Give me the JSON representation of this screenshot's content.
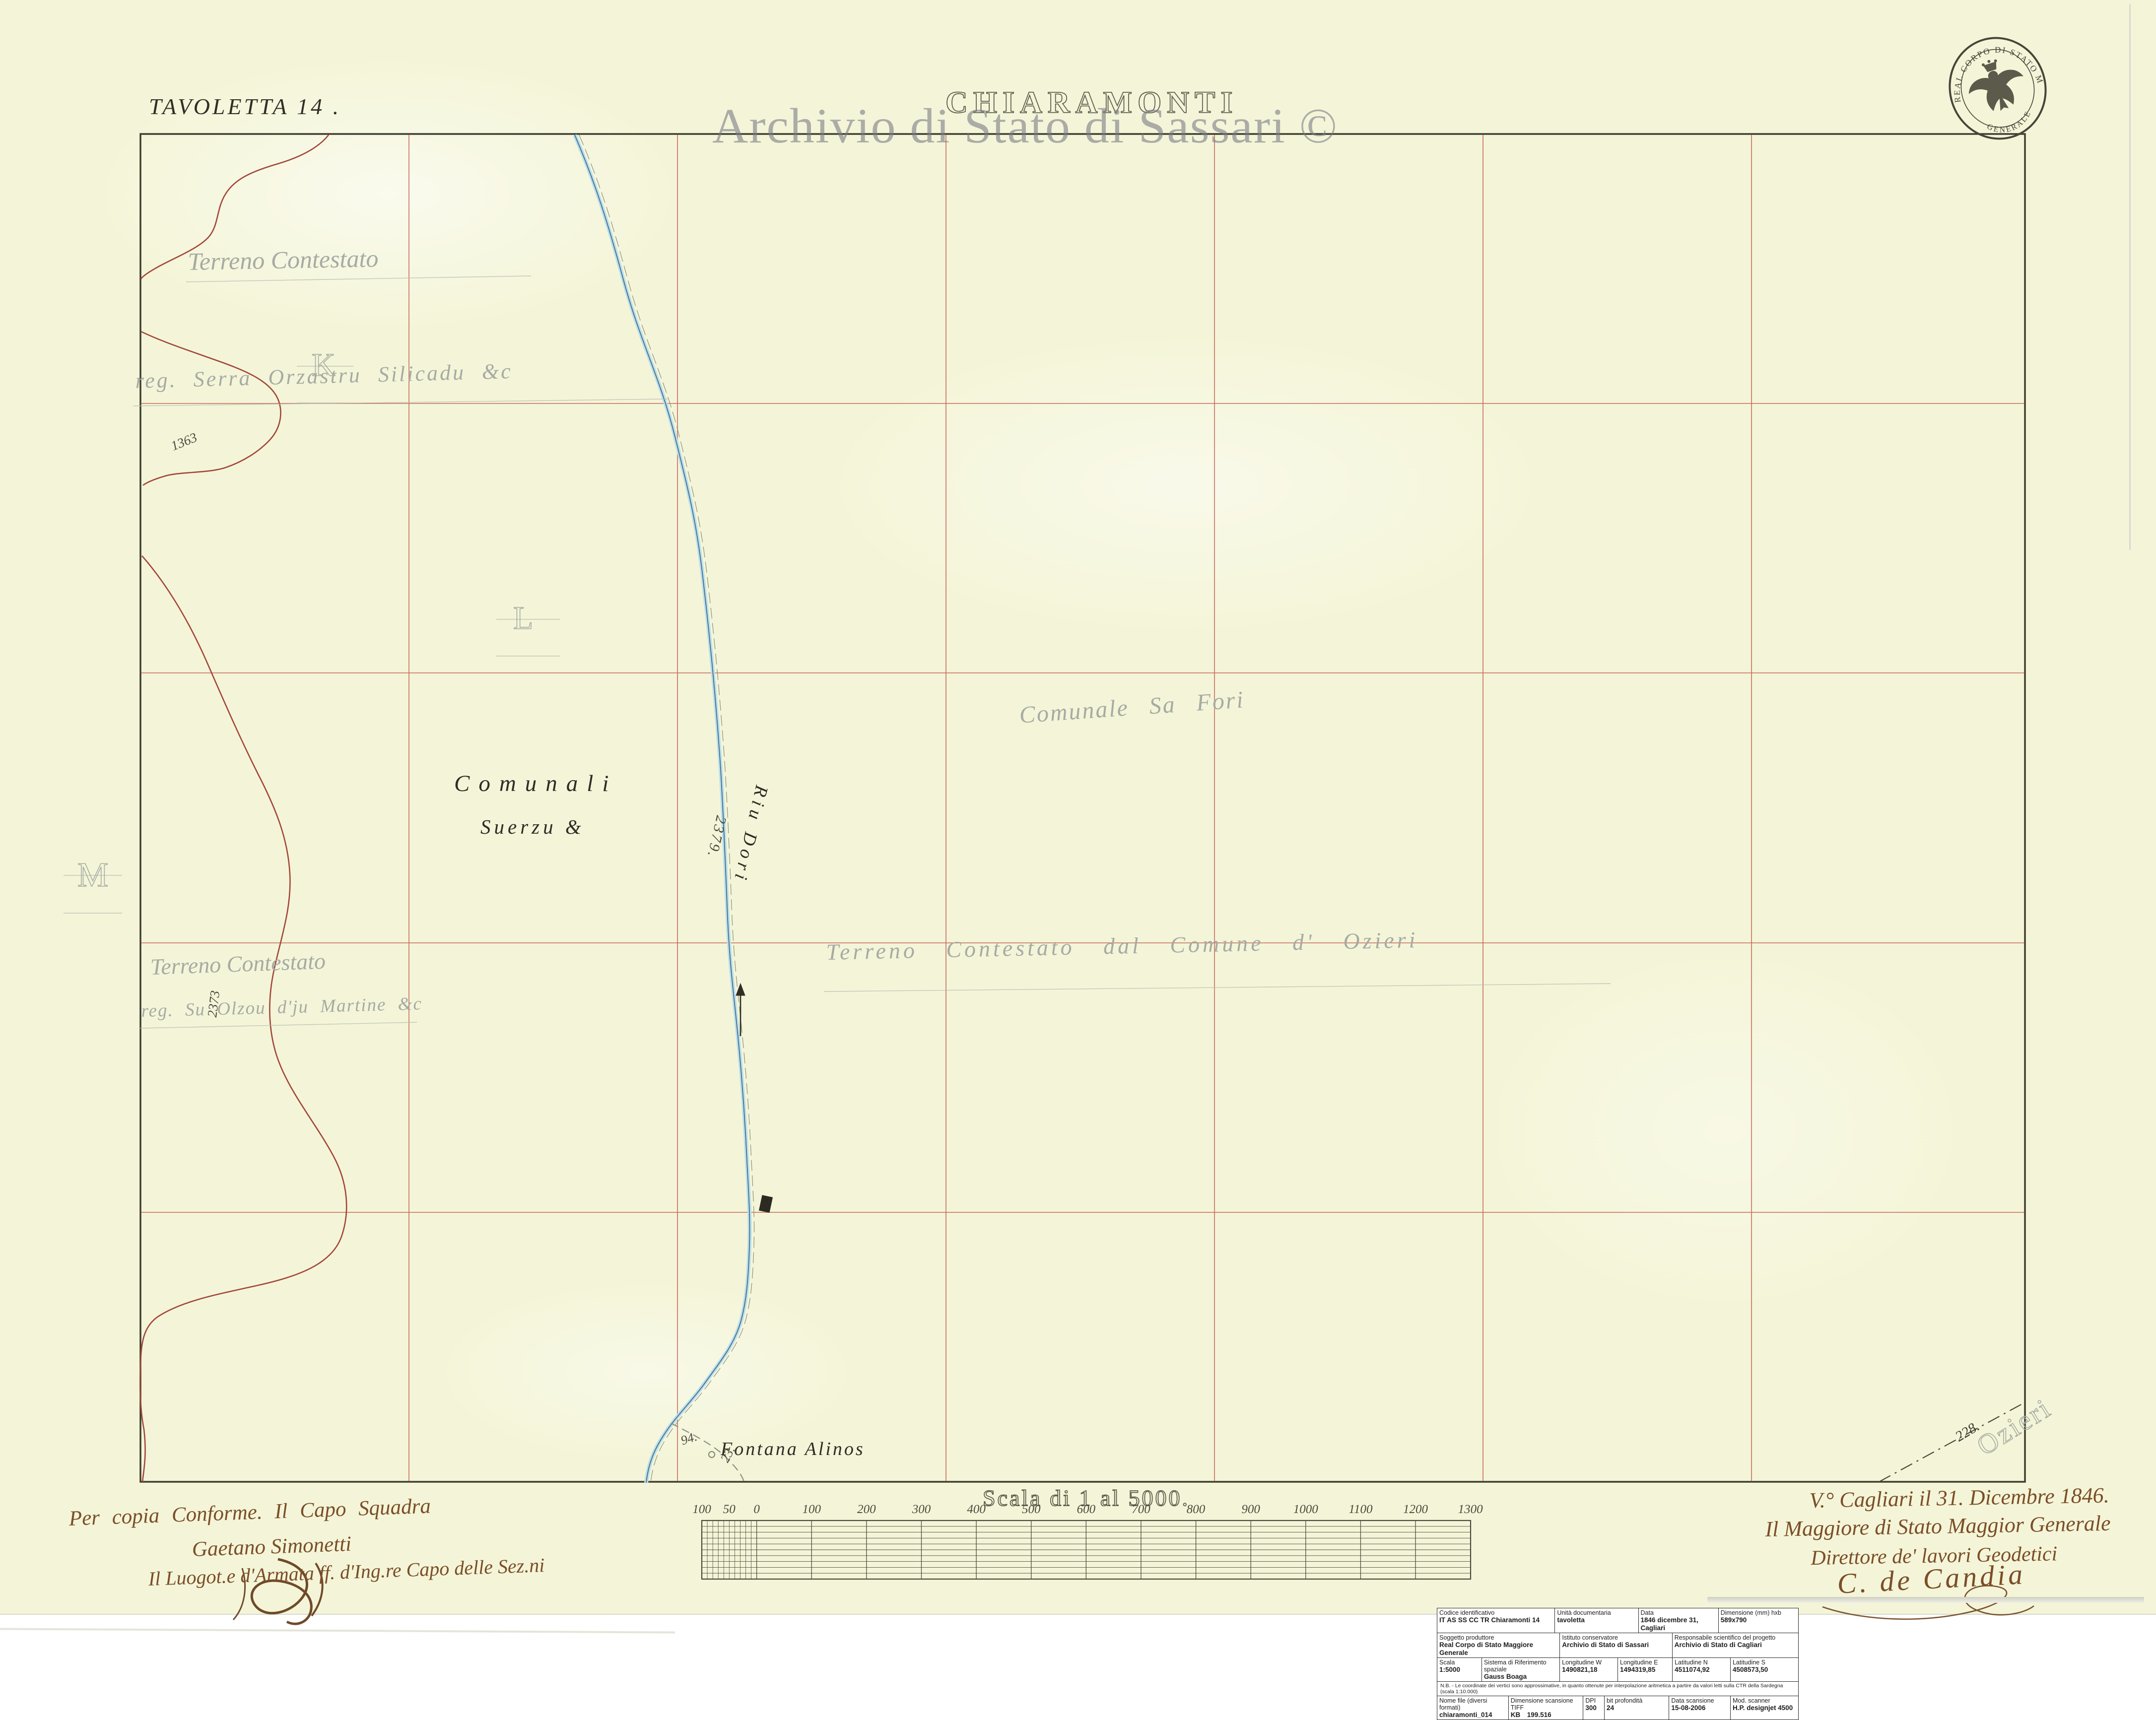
{
  "page": {
    "watermark": "Archivio di Stato di Sassari ©"
  },
  "header": {
    "sheet_label": "TAVOLETTA 14 .",
    "title": "CHIARAMONTI"
  },
  "stamp": {
    "text_top": "REAL CORPO DI STATO MAGGIORE",
    "text_bottom": "GENERALE"
  },
  "map": {
    "labels": {
      "comunali": "Comunali",
      "suerzu": "Suerzu &",
      "river": "Riu Dori",
      "fontana": "Fontana Alinos",
      "elev_1363": "1363",
      "elev_2373": "2373",
      "elev_2379": "2379.",
      "elev_94": "94.",
      "elev_23": "23.",
      "elev_228": "228."
    },
    "pencil": {
      "letter_k": "K",
      "letter_l": "L",
      "letter_m": "M",
      "nw_line1": "Terreno Contestato",
      "nw_line2": "reg. Serra Orzastru Silicadu &c",
      "sw_line1": "Terreno Contestato",
      "sw_line2": "reg. Su Olzou d'ju Martine &c",
      "center_line1": "Comunale Sa Fori",
      "center_line2": "Terreno Contestato dal Comune d' Ozieri",
      "ozieri": "Ozieri"
    }
  },
  "scalebar": {
    "title": "Scala di 1 al 5000.",
    "ticks": [
      "100",
      "50",
      "0",
      "100",
      "200",
      "300",
      "400",
      "500",
      "600",
      "700",
      "800",
      "900",
      "1000",
      "1100",
      "1200",
      "1300"
    ]
  },
  "inscriptions": {
    "left_line1": "Per copia Conforme.  Il Capo Squadra",
    "left_line2": "Gaetano Simonetti",
    "left_line3": "Il Luogot.e d'Armata ff. d'Ing.re Capo delle Sez.ni",
    "right_line1": "V.° Cagliari il 31. Dicembre 1846.",
    "right_line2": "Il Maggiore di Stato Maggior Generale",
    "right_line3": "Direttore de' lavori Geodetici",
    "right_signature": "C. de Candia"
  },
  "table": {
    "rows": [
      {
        "h": 32,
        "cells": [
          {
            "label": "Codice identificativo",
            "value": "IT AS SS CC TR  Chiaramonti 14",
            "w": 33
          },
          {
            "label": "Unità documentaria",
            "value": "tavoletta",
            "w": 23
          },
          {
            "label": "Data",
            "value": "1846 dicembre 31, Cagliari",
            "w": 22
          },
          {
            "label": "Dimensione (mm) hxb",
            "value": "589x790",
            "w": 22
          }
        ]
      },
      {
        "h": 34,
        "cells": [
          {
            "label": "Soggetto produttore",
            "value": "Real Corpo di Stato Maggiore Generale",
            "w": 34
          },
          {
            "label": "Istituto conservatore",
            "value": "Archivio di Stato di Sassari",
            "w": 31
          },
          {
            "label": "Responsabile scientifico del progetto",
            "value": "Archivio di Stato di Cagliari",
            "w": 35
          }
        ]
      },
      {
        "h": 36,
        "cells": [
          {
            "label": "Scala",
            "value": "1:5000",
            "w": 12
          },
          {
            "label": "Sistema di Riferimento spaziale",
            "value": "Gauss Boaga",
            "w": 22
          },
          {
            "label": "Longitudine W",
            "value": "1490821,18",
            "w": 16
          },
          {
            "label": "Longitudine E",
            "value": "1494319,85",
            "w": 15
          },
          {
            "label": "Latitudine N",
            "value": "4511074,92",
            "w": 16
          },
          {
            "label": "Latitudine S",
            "value": "4508573,50",
            "w": 19
          }
        ]
      },
      {
        "h": 18,
        "note": "N.B. - Le coordinate dei vertici sono approssimative, in quanto ottenute per interpolazione aritmetica a partire da valori letti sulla CTR della Sardegna (scala 1:10.000)"
      },
      {
        "h": 34,
        "cells": [
          {
            "label": "Nome file (diversi formati)",
            "value": "chiaramonti_014",
            "w": 20
          },
          {
            "label": "Dimensione scansione TIFF",
            "value": "KB 199.516",
            "w": 21
          },
          {
            "label": "DPI",
            "value": "300",
            "w": 5
          },
          {
            "label": "bit profondità",
            "value": "24",
            "w": 18
          },
          {
            "label": "Data scansione",
            "value": "15-08-2006",
            "w": 17
          },
          {
            "label": "Mod. scanner",
            "value": "H.P. designjet 4500",
            "w": 19
          }
        ]
      }
    ]
  }
}
